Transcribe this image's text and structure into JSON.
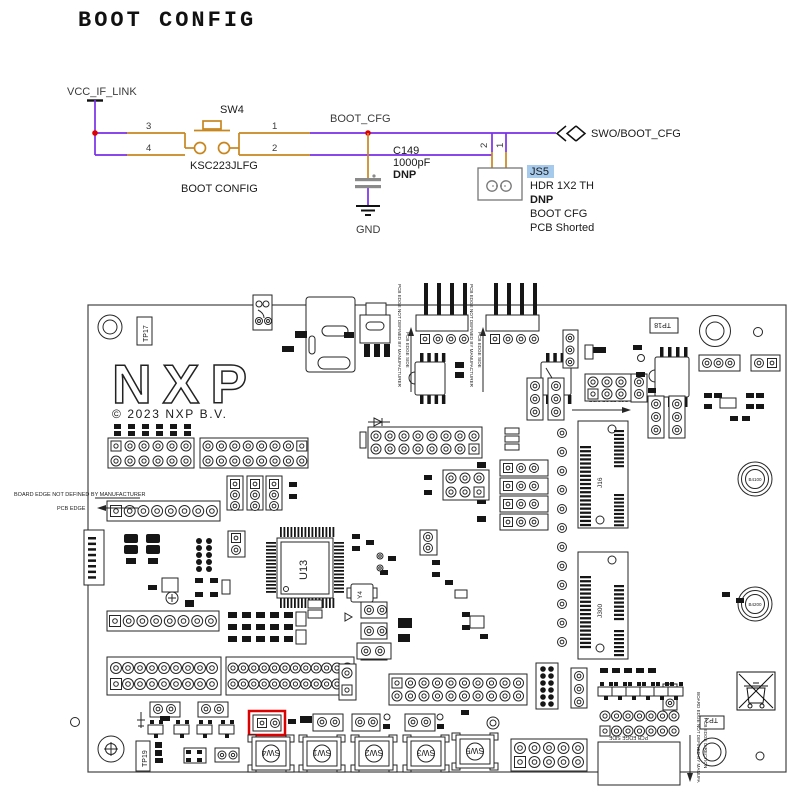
{
  "page": {
    "title": "BOOT CONFIG"
  },
  "colors": {
    "wire": "#7A2EE8",
    "pin": "#C8861E",
    "net_label": "#3b3b3b",
    "magenta": "#FF00FF",
    "red": "#FF0000",
    "blue": "#2222CC",
    "junction": "#E00000",
    "js5_highlight": "#A6CAEC",
    "board_highlight": "#DD0000"
  },
  "schematic": {
    "vcc": "VCC_IF_LINK",
    "sw_ref": "SW4",
    "sw_part": "KSC223JLFG",
    "sw_desc": "BOOT CONFIG",
    "pin3": "3",
    "pin4": "4",
    "pin1": "1",
    "pin2": "2",
    "net": "BOOT_CFG",
    "cap_ref": "C149",
    "cap_val": "1000pF",
    "cap_dnp": "DNP",
    "gnd": "GND",
    "js_pin2": "2",
    "js_pin1": "1",
    "js_ref": "JS5",
    "js_part": "HDR 1X2 TH",
    "js_dnp": "DNP",
    "js_desc": "BOOT CFG",
    "js_note": "PCB Shorted",
    "offpage": "SWO/BOOT_CFG"
  },
  "board": {
    "logo": "NXP",
    "copyright": "© 2023 NXP B.V.",
    "tp17": "TP17",
    "tp18": "TP18",
    "tp19": "TP19",
    "tp2": "TP2",
    "u13": "U13",
    "y4": "Y4",
    "sw1": "SW1",
    "sw2": "SW2",
    "sw3": "SW3",
    "sw4": "SW4",
    "sw5": "SW5",
    "b4100": "B4100",
    "b4200": "B4200",
    "j16": "J16",
    "j300": "J300",
    "edge_left1": "BOARD EDGE NOT DEFINED BY MANUFACTURER",
    "edge_left2": "PCB EDGE",
    "edge_top": "PCB EDGE NOT DEFINED BY MANUFACTURER",
    "edge_side": "PCB EDGE SIDE",
    "edge_right1": "BOARD EDGE NOT DEFINED BY MANUFA",
    "edge_right2": "PCB EDGE DIRECTION"
  }
}
